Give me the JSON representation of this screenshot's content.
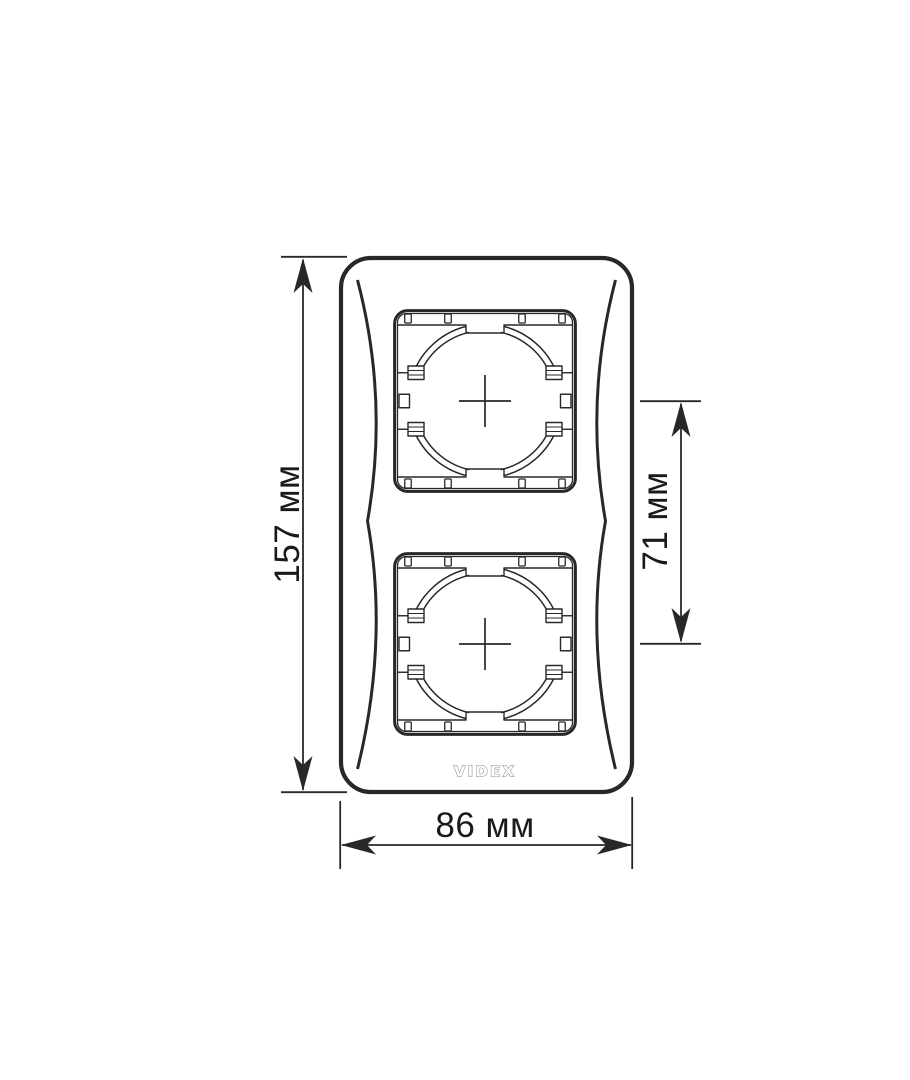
{
  "page": {
    "background_color": "#ffffff"
  },
  "product_drawing": {
    "brand_logo": "VIDEX",
    "line_color": "#282828",
    "text_color": "#1a1a1a",
    "logo_color": "#8a8a8a",
    "dimensions": {
      "overall_height": "157 мм",
      "overall_width": "86 мм",
      "module_center_spacing": "71 мм"
    }
  }
}
